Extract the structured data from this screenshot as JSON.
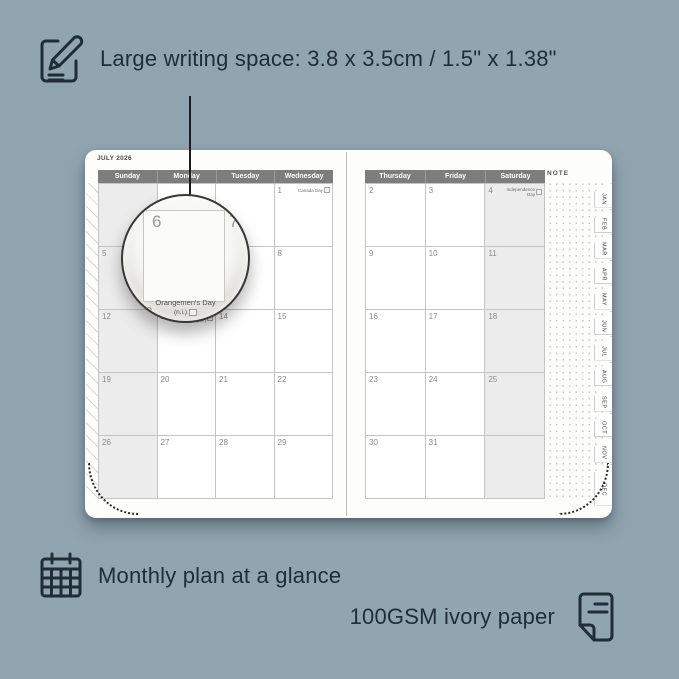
{
  "colors": {
    "background": "#91a5b1",
    "ink": "#1e2d37",
    "header_bg": "#7d7d7d",
    "header_text": "#ffffff",
    "weekend_bg": "#ececec",
    "grid_line": "#c4c4c4",
    "date_text": "#8a8a8a",
    "page_bg": "#fdfdfc"
  },
  "callouts": {
    "top": {
      "icon": "pencil-note-icon",
      "text": "Large writing space: 3.8 x 3.5cm / 1.5\" x 1.38\""
    },
    "bottom_left": {
      "icon": "calendar-grid-icon",
      "text": "Monthly plan at a glance"
    },
    "bottom_right": {
      "icon": "paper-icon",
      "text": "100GSM ivory paper"
    }
  },
  "planner": {
    "month_title": "JULY 2026",
    "note_label": "NOTE",
    "left_headers": [
      "Sunday",
      "Monday",
      "Tuesday",
      "Wednesday"
    ],
    "right_headers": [
      "Thursday",
      "Friday",
      "Saturday"
    ],
    "left_rows": [
      [
        {
          "d": ""
        },
        {
          "d": ""
        },
        {
          "d": ""
        },
        {
          "d": "1",
          "h": "Canada Day"
        }
      ],
      [
        {
          "d": "5"
        },
        {
          "d": "6"
        },
        {
          "d": "7"
        },
        {
          "d": "8"
        }
      ],
      [
        {
          "d": "12"
        },
        {
          "d": "13",
          "h": "Orangemen's Day (n.i.)"
        },
        {
          "d": "14"
        },
        {
          "d": "15"
        }
      ],
      [
        {
          "d": "19"
        },
        {
          "d": "20"
        },
        {
          "d": "21"
        },
        {
          "d": "22"
        }
      ],
      [
        {
          "d": "26"
        },
        {
          "d": "27"
        },
        {
          "d": "28"
        },
        {
          "d": "29"
        }
      ]
    ],
    "right_rows": [
      [
        {
          "d": "2"
        },
        {
          "d": "3"
        },
        {
          "d": "4",
          "h": "Independence Day"
        }
      ],
      [
        {
          "d": "9"
        },
        {
          "d": "10"
        },
        {
          "d": "11"
        }
      ],
      [
        {
          "d": "16"
        },
        {
          "d": "17"
        },
        {
          "d": "18"
        }
      ],
      [
        {
          "d": "23"
        },
        {
          "d": "24"
        },
        {
          "d": "25"
        }
      ],
      [
        {
          "d": "30"
        },
        {
          "d": "31"
        },
        {
          "d": ""
        }
      ]
    ],
    "month_tabs": [
      "JAN",
      "FEB",
      "MAR",
      "APR",
      "MAY",
      "JUN",
      "JUL",
      "AUG",
      "SEP",
      "OCT",
      "NOV",
      "DEC"
    ],
    "magnifier": {
      "date_main": "6",
      "date_next": "7",
      "date_below": "13",
      "holiday": "Orangemen's Day",
      "holiday_note": "(n.i.)"
    }
  }
}
